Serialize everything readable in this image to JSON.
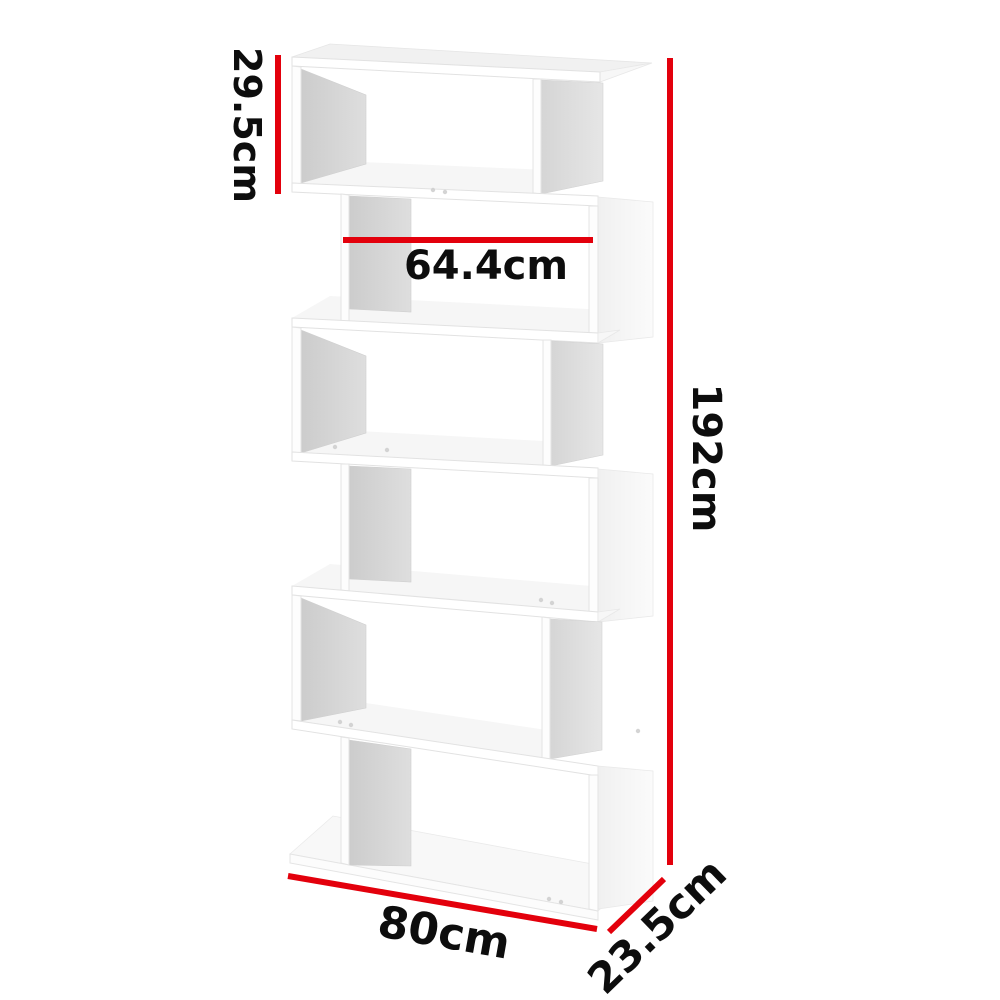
{
  "diagram": {
    "type": "product-dimension-diagram",
    "subject": "white s-shaped zigzag display shelf with six tiers",
    "labels": {
      "tier_height": "29.5cm",
      "inner_width": "64.4cm",
      "overall_height": "192cm",
      "overall_width": "80cm",
      "depth": "23.5cm"
    },
    "dimensions": {
      "tier_height_cm": 29.5,
      "inner_width_cm": 64.4,
      "overall_height_cm": 192,
      "overall_width_cm": 80,
      "depth_cm": 23.5,
      "unit": "cm"
    },
    "colors": {
      "dimension_line": "#e3000c",
      "label_text": "#0d0d0d",
      "background": "#ffffff",
      "shelf_fill": "#ffffff",
      "shelf_inner_shade": "#d6d6d6",
      "shelf_edge": "#e2e2e2"
    }
  }
}
